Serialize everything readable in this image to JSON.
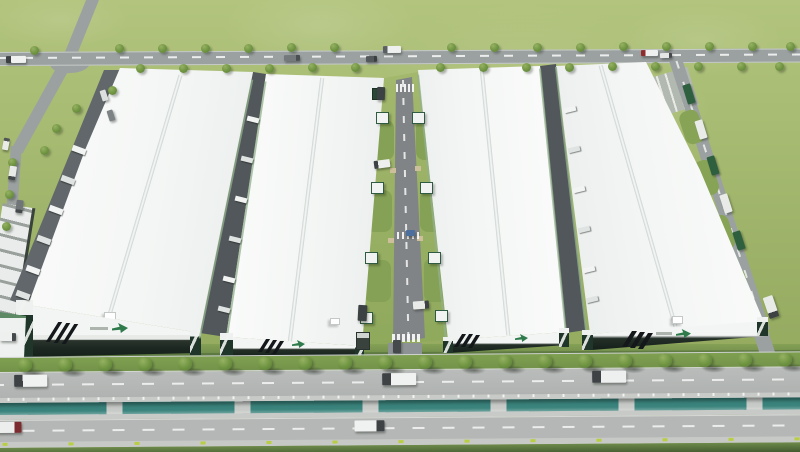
{
  "scene": {
    "description": "Aerial 3D rendering of a logistics industrial park: four long white-roofed warehouse buildings with dark green striped facades and green brand logos, a central landscaped access road with loading docks, perimeter roads with roadside trees, parked container trucks, and a front boulevard divided by a teal water canal with trucks driving on both carriageways.",
    "counts": {
      "warehouses": 4,
      "roadside_trees": 58,
      "vehicles": 29,
      "dock_trailers": 18
    },
    "palette": {
      "grass": "#9cb168",
      "grass_dark": "#6d8a4a",
      "road": "#9ba1a1",
      "road_light": "#b5b8b6",
      "roof_white": "#f4f6f5",
      "facade_dark": "#1f2a24",
      "brand_green": "#2f7b4c",
      "canal_water": "#3a837c",
      "marker_yellow": "#b9ce41",
      "tree_green": "#6f9441"
    },
    "trees": {
      "scene": [
        [
          115,
          44
        ],
        [
          158,
          44
        ],
        [
          201,
          44
        ],
        [
          244,
          44
        ],
        [
          287,
          43
        ],
        [
          330,
          43
        ],
        [
          447,
          43
        ],
        [
          490,
          43
        ],
        [
          533,
          43
        ],
        [
          576,
          43
        ],
        [
          619,
          42
        ],
        [
          662,
          42
        ],
        [
          705,
          42
        ],
        [
          748,
          42
        ],
        [
          786,
          42
        ],
        [
          136,
          64
        ],
        [
          179,
          64
        ],
        [
          222,
          64
        ],
        [
          265,
          64
        ],
        [
          308,
          63
        ],
        [
          351,
          63
        ],
        [
          436,
          63
        ],
        [
          479,
          63
        ],
        [
          522,
          63
        ],
        [
          565,
          63
        ],
        [
          608,
          62
        ],
        [
          651,
          62
        ],
        [
          694,
          62
        ],
        [
          737,
          62
        ],
        [
          775,
          62
        ],
        [
          108,
          86
        ],
        [
          72,
          104
        ],
        [
          52,
          124
        ],
        [
          40,
          146
        ],
        [
          30,
          46
        ],
        [
          8,
          158
        ],
        [
          5,
          190
        ],
        [
          2,
          222
        ]
      ],
      "band": [
        [
          26,
          1
        ],
        [
          66,
          1
        ],
        [
          106,
          1
        ],
        [
          146,
          1
        ],
        [
          186,
          1
        ],
        [
          226,
          1
        ],
        [
          266,
          1
        ],
        [
          306,
          1
        ],
        [
          346,
          1
        ],
        [
          386,
          1
        ],
        [
          426,
          1
        ],
        [
          466,
          1
        ],
        [
          506,
          1
        ],
        [
          546,
          1
        ],
        [
          586,
          1
        ],
        [
          626,
          1
        ],
        [
          666,
          1
        ],
        [
          706,
          1
        ],
        [
          746,
          1
        ],
        [
          786,
          1
        ]
      ]
    },
    "vehicles": {
      "scene": [
        {
          "x": 6,
          "y": 56,
          "w": 20,
          "h": 7,
          "r": -1,
          "b": "#f0f2f1",
          "c": "#3c4043",
          "a": 90
        },
        {
          "x": 284,
          "y": 55,
          "w": 16,
          "h": 6,
          "r": -1,
          "b": "#74797c",
          "c": "#4a4f52",
          "a": 270
        },
        {
          "x": 383,
          "y": 46,
          "w": 18,
          "h": 7,
          "r": -1,
          "b": "#eef0ef",
          "c": "#5a5f62",
          "a": 90
        },
        {
          "x": 366,
          "y": 56,
          "w": 11,
          "h": 6,
          "r": -1,
          "b": "#53585a",
          "c": "#3a3e40",
          "a": 270
        },
        {
          "x": 641,
          "y": 50,
          "w": 17,
          "h": 6,
          "r": -1,
          "b": "#eef0ef",
          "c": "#8f2a2c",
          "a": 90
        },
        {
          "x": 660,
          "y": 53,
          "w": 12,
          "h": 5,
          "r": -1,
          "b": "#e4e6e5",
          "c": "#45494b",
          "a": 270
        },
        {
          "x": 9,
          "y": 166,
          "w": 7,
          "h": 14,
          "r": 9,
          "b": "#e9ebe9",
          "c": "#45494b",
          "a": 0
        },
        {
          "x": 16,
          "y": 200,
          "w": 7,
          "h": 13,
          "r": 7,
          "b": "#707578",
          "c": "#45494b",
          "a": 0
        },
        {
          "x": 3,
          "y": 138,
          "w": 6,
          "h": 12,
          "r": 11,
          "b": "#e9ebe9",
          "c": "#505456",
          "a": 180
        },
        {
          "x": 101,
          "y": 90,
          "w": 6,
          "h": 11,
          "r": -18,
          "b": "#dcdfdd"
        },
        {
          "x": 108,
          "y": 110,
          "w": 6,
          "h": 11,
          "r": -18,
          "b": "#7d8285"
        },
        {
          "x": 374,
          "y": 160,
          "w": 16,
          "h": 8,
          "r": -8,
          "b": "#eef0ef",
          "c": "#3e4245",
          "a": 90
        },
        {
          "x": 406,
          "y": 230,
          "w": 9,
          "h": 6,
          "r": 0,
          "b": "#4c6f9e"
        },
        {
          "x": 358,
          "y": 305,
          "w": 9,
          "h": 16,
          "r": 3,
          "b": "#3c4143"
        },
        {
          "x": 413,
          "y": 301,
          "w": 16,
          "h": 8,
          "r": -4,
          "b": "#e9ebe9",
          "c": "#3e4245",
          "a": 270
        },
        {
          "x": 393,
          "y": 340,
          "w": 8,
          "h": 13,
          "r": 0,
          "b": "#45494b"
        },
        {
          "x": 377,
          "y": 87,
          "w": 8,
          "h": 13,
          "r": 2,
          "b": "#3c4143"
        },
        {
          "x": 685,
          "y": 84,
          "w": 8,
          "h": 20,
          "r": -17,
          "b": "#2e5f3f"
        },
        {
          "x": 697,
          "y": 120,
          "w": 8,
          "h": 19,
          "r": -17,
          "b": "#e9ebe9"
        },
        {
          "x": 709,
          "y": 156,
          "w": 8,
          "h": 19,
          "r": -17,
          "b": "#2e5f3f"
        },
        {
          "x": 722,
          "y": 194,
          "w": 8,
          "h": 19,
          "r": -18,
          "b": "#e9ebe9"
        },
        {
          "x": 735,
          "y": 231,
          "w": 8,
          "h": 19,
          "r": -18,
          "b": "#2e5f3f"
        },
        {
          "x": 766,
          "y": 296,
          "w": 10,
          "h": 22,
          "r": -19,
          "b": "#e9ebe9",
          "c": "#3e4245",
          "a": 0
        },
        {
          "x": 0,
          "y": 333,
          "w": 16,
          "h": 8,
          "r": 1,
          "b": "#eef0ef",
          "c": "#45494b",
          "a": 270
        }
      ],
      "band": [
        {
          "x": 22,
          "y": 18,
          "w": 33,
          "h": 12,
          "r": 0,
          "b": "#f0f2f1",
          "c": "#3e4245",
          "a": 90
        },
        {
          "x": 390,
          "y": 19,
          "w": 34,
          "h": 12,
          "r": 0,
          "b": "#f0f2f1",
          "c": "#3e4245",
          "a": 90
        },
        {
          "x": 600,
          "y": 18,
          "w": 34,
          "h": 12,
          "r": 0,
          "b": "#eef0ef",
          "c": "#3e4245",
          "a": 90
        },
        {
          "x": 2,
          "y": 65,
          "w": 27,
          "h": 11,
          "r": 0,
          "b": "#eceeed",
          "c": "#7c2b2e",
          "a": 270
        },
        {
          "x": 362,
          "y": 66,
          "w": 30,
          "h": 11,
          "r": 0,
          "b": "#f0f2f1",
          "c": "#3e4245",
          "a": 270
        }
      ]
    },
    "trailers": [
      {
        "r": 20,
        "w": 14,
        "h": 6,
        "pts": [
          [
            72,
            147
          ],
          [
            61,
            177
          ],
          [
            49,
            207
          ],
          [
            37,
            237
          ],
          [
            26,
            267
          ],
          [
            16,
            292
          ]
        ]
      },
      {
        "r": 14,
        "w": 12,
        "h": 5,
        "pts": [
          [
            247,
            117
          ],
          [
            241,
            157
          ],
          [
            235,
            197
          ],
          [
            229,
            237
          ],
          [
            223,
            277
          ],
          [
            218,
            307
          ]
        ]
      },
      {
        "r": -14,
        "w": 12,
        "h": 5,
        "pts": [
          [
            564,
            107
          ],
          [
            568,
            147
          ],
          [
            573,
            187
          ],
          [
            578,
            227
          ],
          [
            583,
            267
          ],
          [
            586,
            297
          ]
        ]
      }
    ]
  }
}
